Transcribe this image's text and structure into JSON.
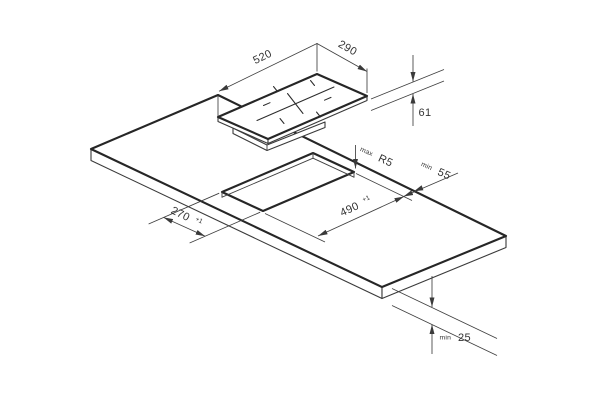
{
  "drawing": {
    "background": "#ffffff",
    "stroke_color": "#262626",
    "type_hint": "cooktop installation cutout diagram",
    "dimensions": {
      "cooktop_width": "520",
      "cooktop_depth": "290",
      "cooktop_height": "61",
      "corner_radius_prefix": "max",
      "corner_radius_value": "R5",
      "edge_clearance_prefix": "min",
      "edge_clearance_value": "55",
      "cutout_width": "490",
      "cutout_width_tolerance": "+1",
      "cutout_depth": "270",
      "cutout_depth_tolerance": "+1",
      "bottom_clearance_prefix": "min",
      "bottom_clearance_value": "25"
    }
  }
}
